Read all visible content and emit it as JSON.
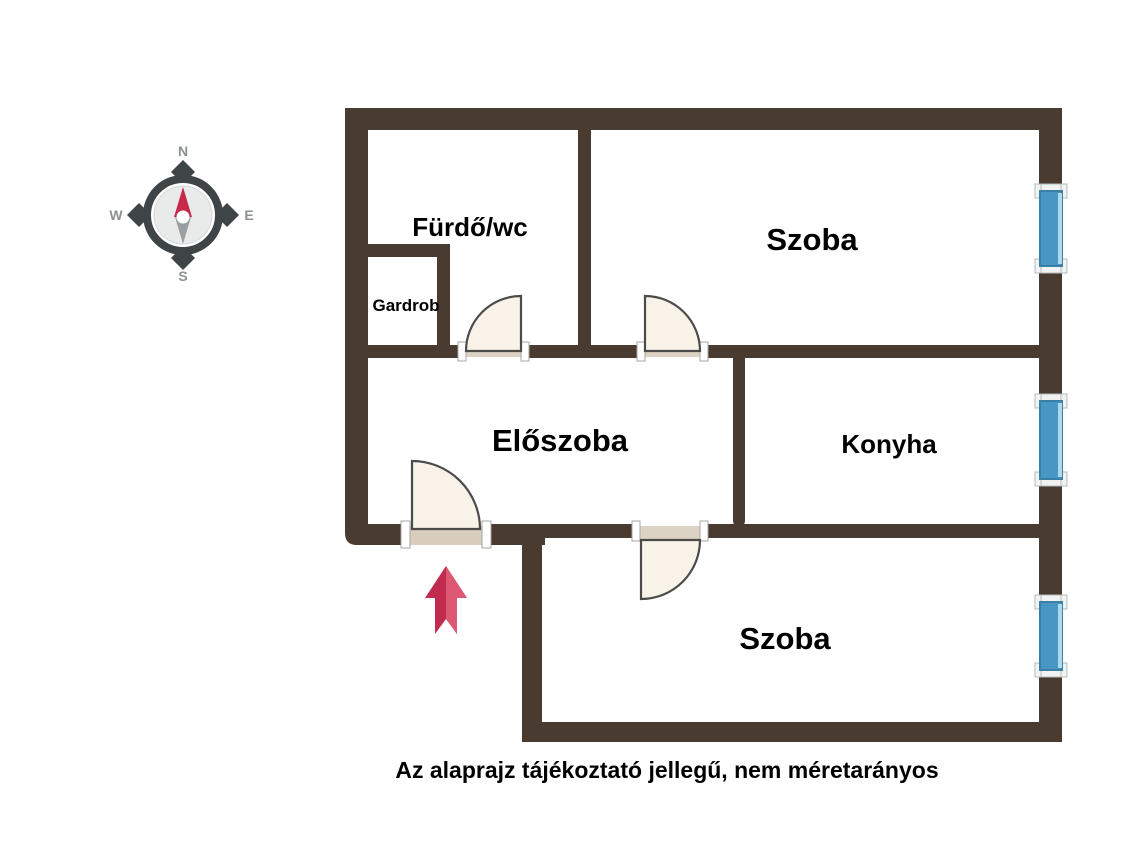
{
  "rooms": {
    "bathroom": "Fürdő/wc",
    "wardrobe": "Gardrob",
    "room_top": "Szoba",
    "hallway": "Előszoba",
    "kitchen": "Konyha",
    "room_bottom": "Szoba"
  },
  "compass": {
    "n": "N",
    "e": "E",
    "s": "S",
    "w": "W"
  },
  "caption": "Az alaprajz tájékoztató jellegű, nem méretarányos",
  "colors": {
    "wall": "#4a3b31",
    "door_fill": "#f8f2e9",
    "door_stroke": "#4b4b49",
    "threshold": "#d9cdbc",
    "window_blue": "#4796c3",
    "window_blue_dark": "#3a7fa6",
    "window_blue_light": "#aed9eb",
    "sill_gray": "#f1f3f3",
    "arrow_dark": "#c12b4f",
    "arrow_light": "#de5874",
    "compass_ring": "#3f4447",
    "compass_face": "#e9ebeb",
    "needle_north": "#c6294a",
    "needle_south": "#9aa0a2",
    "compass_letters": "#8b9193",
    "text": "#000000"
  }
}
